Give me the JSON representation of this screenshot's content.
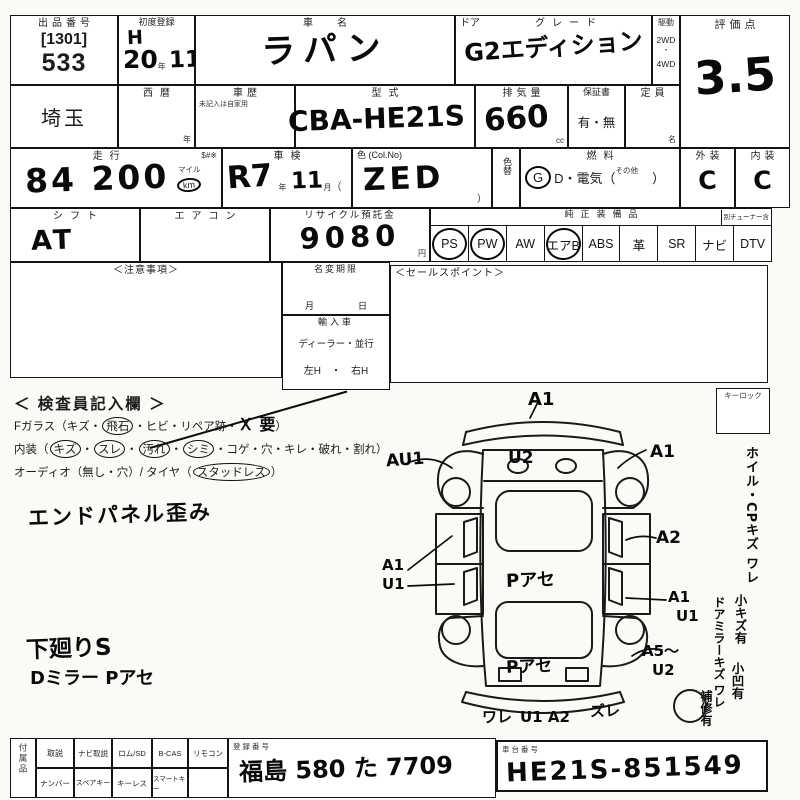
{
  "row1": {
    "lot": {
      "label": "出品番号",
      "bracket": "[1301]",
      "number": "533"
    },
    "first_reg": {
      "label": "初度登録",
      "era": "H",
      "year": "20",
      "year_unit": "年",
      "month": "11",
      "month_unit": "月"
    },
    "car_name": {
      "label": "車　名",
      "value": "ラパン"
    },
    "grade": {
      "door_label": "ドア",
      "label": "グレード",
      "value": "G2エディション"
    },
    "drive": {
      "label": "駆動",
      "opt1": "2WD",
      "opt2": "4WD"
    },
    "score": {
      "label": "評価点",
      "value": "3.5"
    }
  },
  "row2": {
    "prefecture": "埼玉",
    "seireki": {
      "label": "西暦",
      "unit": "年"
    },
    "history": {
      "label": "車歴",
      "note": "未記入は自家用"
    },
    "model": {
      "label": "型式",
      "value": "CBA-HE21S"
    },
    "displacement": {
      "label": "排気量",
      "value": "660",
      "unit": "cc"
    },
    "warranty": {
      "label": "保証書",
      "options": "有・無"
    },
    "capacity": {
      "label": "定員",
      "unit": "名"
    }
  },
  "row3": {
    "mileage": {
      "label": "走行",
      "marks": "$#※",
      "value": "84 200",
      "unit_top": "マイル",
      "unit_circled": "km"
    },
    "shaken": {
      "label": "車検",
      "era_year": "R7",
      "year_unit": "年",
      "month": "11",
      "month_unit": "月",
      "paren": "（"
    },
    "color": {
      "label": "色 (Col.No)",
      "value": "ZED",
      "close_paren": "）"
    },
    "color_change": {
      "label": "色替"
    },
    "fuel": {
      "label": "燃料",
      "g": "G",
      "mid": "D・電気（",
      "other": "その他",
      "close": "）"
    },
    "exterior": {
      "label": "外装",
      "value": "C"
    },
    "interior": {
      "label": "内装",
      "value": "C"
    }
  },
  "row4": {
    "shift": {
      "label": "シフト",
      "value": "AT"
    },
    "aircon": {
      "label": "エアコン"
    },
    "recycle": {
      "label": "リサイクル預託金",
      "value": "9080",
      "unit": "円"
    },
    "equipment": {
      "label": "純正装備品",
      "tuner_note": "別チューナー含",
      "items": [
        {
          "label": "PS",
          "circled": true
        },
        {
          "label": "PW",
          "circled": true
        },
        {
          "label": "AW",
          "circled": false
        },
        {
          "label": "エアB",
          "circled": true
        },
        {
          "label": "ABS",
          "circled": false
        },
        {
          "label": "革",
          "circled": false
        },
        {
          "label": "SR",
          "circled": false
        },
        {
          "label": "ナビ",
          "circled": false
        },
        {
          "label": "DTV",
          "circled": false
        }
      ]
    }
  },
  "middle": {
    "notes_label": "＜注意事項＞",
    "name_change": {
      "label": "名変期限",
      "month": "月",
      "day": "日"
    },
    "import": {
      "label": "輸入車",
      "line1": "ディーラー・並行",
      "line2": "左H　・　右H"
    },
    "sales_label": "＜セールスポイント＞"
  },
  "inspection": {
    "title": "＜ 検査員記入欄 ＞",
    "fglass": {
      "head": "Fガラス（キズ・",
      "circled": "飛石",
      "mid": "・ヒビ・リペア跡・",
      "hand": "Ｘ 要",
      "tail": "）"
    },
    "interior_line": {
      "head": "内装（",
      "c1": "キズ",
      "c2": "スレ",
      "c3": "汚れ",
      "c4": "シミ",
      "dot": "・",
      "tail": "・コゲ・穴・キレ・破れ・割れ）"
    },
    "audio_line": {
      "head": "オーディオ（無し・穴）/ タイヤ（",
      "circled": "スタッドレス",
      "tail": "）"
    },
    "notes": [
      "エンドパネル歪み",
      "下廻りS",
      "Dミラー Pアセ"
    ]
  },
  "diagram": {
    "keylock_label": "キーロック",
    "ann": {
      "front": "A1",
      "left_front_fender": "AU1",
      "hood": "U2",
      "right_front_fender": "A1",
      "right_front_door": "A2",
      "left_door_a": "A1",
      "left_door_b": "U1",
      "roof": "Pアセ",
      "right_rear_door_a": "A1",
      "right_rear_door_b": "U1",
      "rear_gate": "Pアセ",
      "right_quarter_a": "A5〜",
      "right_quarter_b": "U2",
      "rear_left": "ワレ",
      "rear_center": "U1 A2",
      "rear_right": "ズレ"
    }
  },
  "side_notes": {
    "v1": "ホイル・CPキズ ワレ",
    "v2": "小キズ有",
    "v3": "ドアミラーキズ ワレ",
    "v4": "小凹有",
    "v5": "補修有"
  },
  "bottom": {
    "section_label": "付属品",
    "cells_top": [
      "取説",
      "ナビ取説",
      "ロム/SD",
      "B-CAS",
      "リモコン"
    ],
    "cells_bottom": [
      "ナンバー",
      "スペアキー",
      "キーレス",
      "スマートキー",
      ""
    ],
    "registration": {
      "label": "登録番号",
      "value": "福島 580 た 7709"
    },
    "chassis": {
      "label": "車台番号",
      "value": "HE21S-851549"
    }
  }
}
